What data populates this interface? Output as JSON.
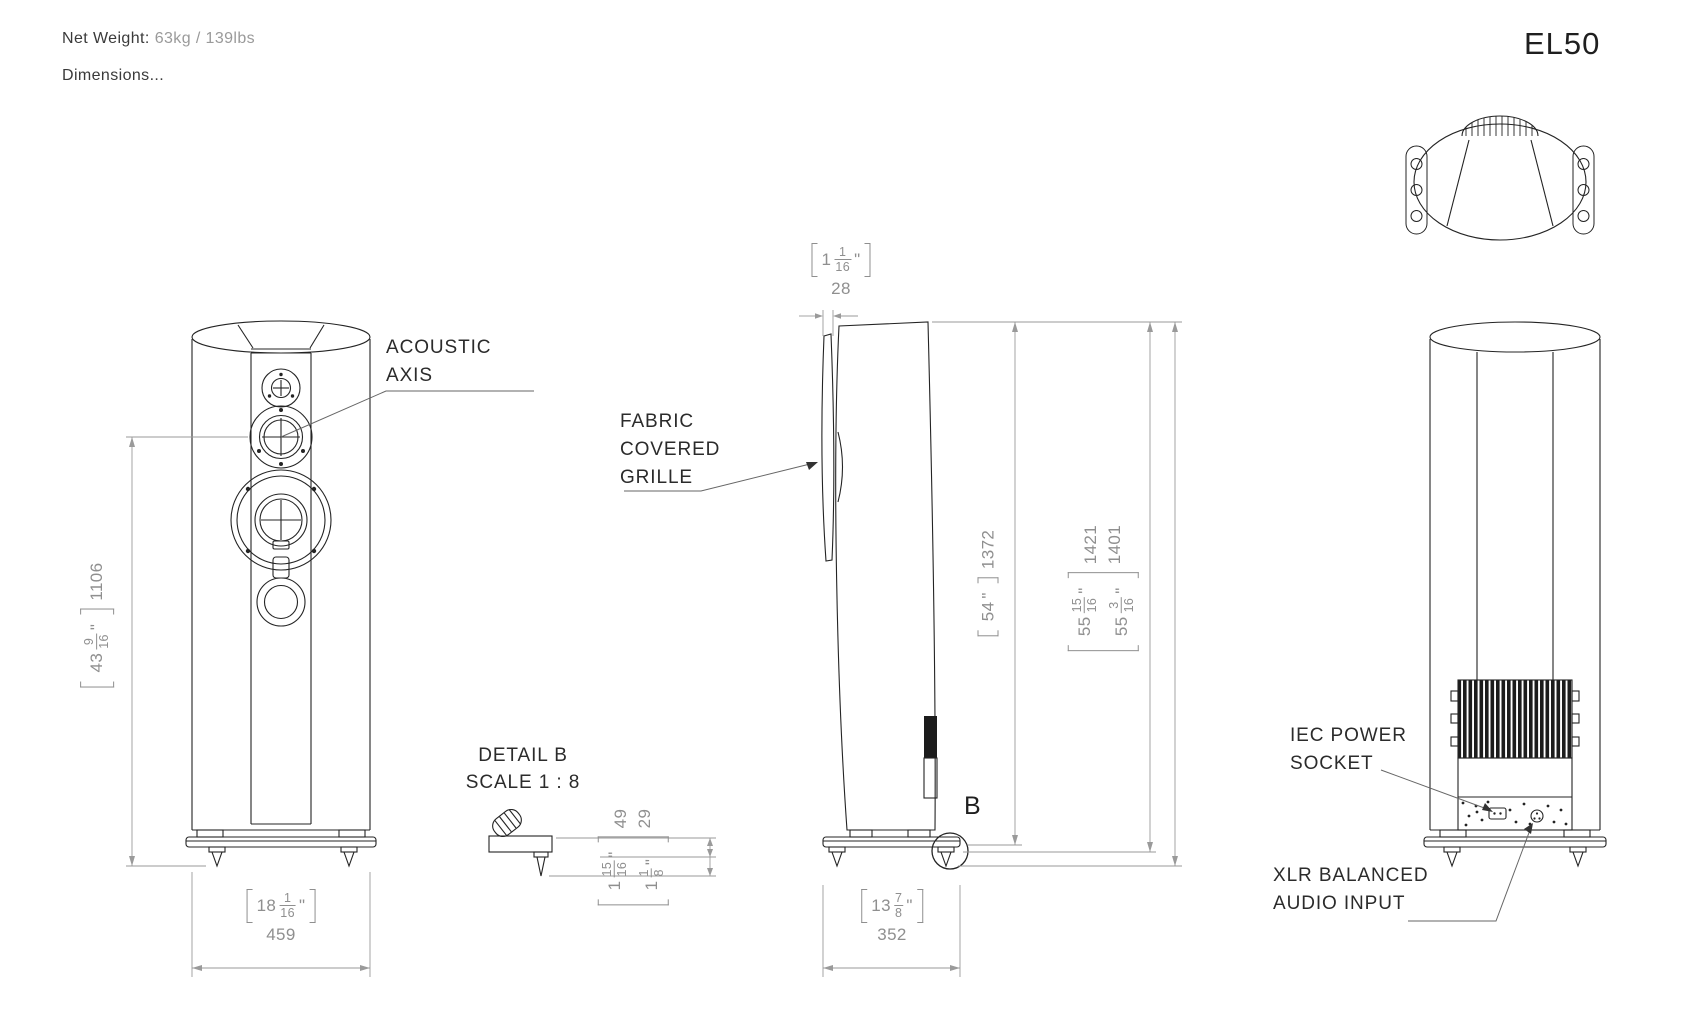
{
  "header": {
    "net_weight_label": "Net Weight:",
    "net_weight_value": "63kg / 139lbs",
    "dimensions_label": "Dimensions...",
    "model": "EL50"
  },
  "annotations": {
    "acoustic_axis_1": "ACOUSTIC",
    "acoustic_axis_2": "AXIS",
    "fabric_1": "FABRIC",
    "fabric_2": "COVERED",
    "fabric_3": "GRILLE",
    "detail_title": "DETAIL B",
    "detail_scale": "SCALE 1 : 8",
    "detail_marker": "B",
    "iec_1": "IEC POWER",
    "iec_2": "SOCKET",
    "xlr_1": "XLR BALANCED",
    "xlr_2": "AUDIO INPUT"
  },
  "dims": {
    "height_axis": {
      "whole": "43",
      "num": "9",
      "den": "16",
      "unit": "\"",
      "mm": "1106"
    },
    "width_front": {
      "whole": "18",
      "num": "1",
      "den": "16",
      "unit": "\"",
      "mm": "459"
    },
    "grille_thk": {
      "whole": "1",
      "num": "1",
      "den": "16",
      "unit": "\"",
      "mm": "28"
    },
    "height_cabinet": {
      "whole": "54",
      "unit": "\"",
      "mm": "1372"
    },
    "height_overall_a": {
      "whole": "55",
      "num": "15",
      "den": "16",
      "unit": "\"",
      "mm": "1421"
    },
    "height_overall_b": {
      "whole": "55",
      "num": "3",
      "den": "16",
      "unit": "\"",
      "mm": "1401"
    },
    "depth": {
      "whole": "13",
      "num": "7",
      "den": "8",
      "unit": "\"",
      "mm": "352"
    },
    "foot_a": {
      "whole": "1",
      "num": "15",
      "den": "16",
      "unit": "\"",
      "mm": "49"
    },
    "foot_b": {
      "whole": "1",
      "num": "1",
      "den": "8",
      "unit": "\"",
      "mm": "29"
    }
  },
  "colors": {
    "background": "#ffffff",
    "geometry_line": "#242424",
    "dimension_line": "#9a9a9a",
    "dimension_text": "#8f8f8f",
    "label_text": "#2b2b2b",
    "heatsink_fill": "#1c1c1c"
  }
}
